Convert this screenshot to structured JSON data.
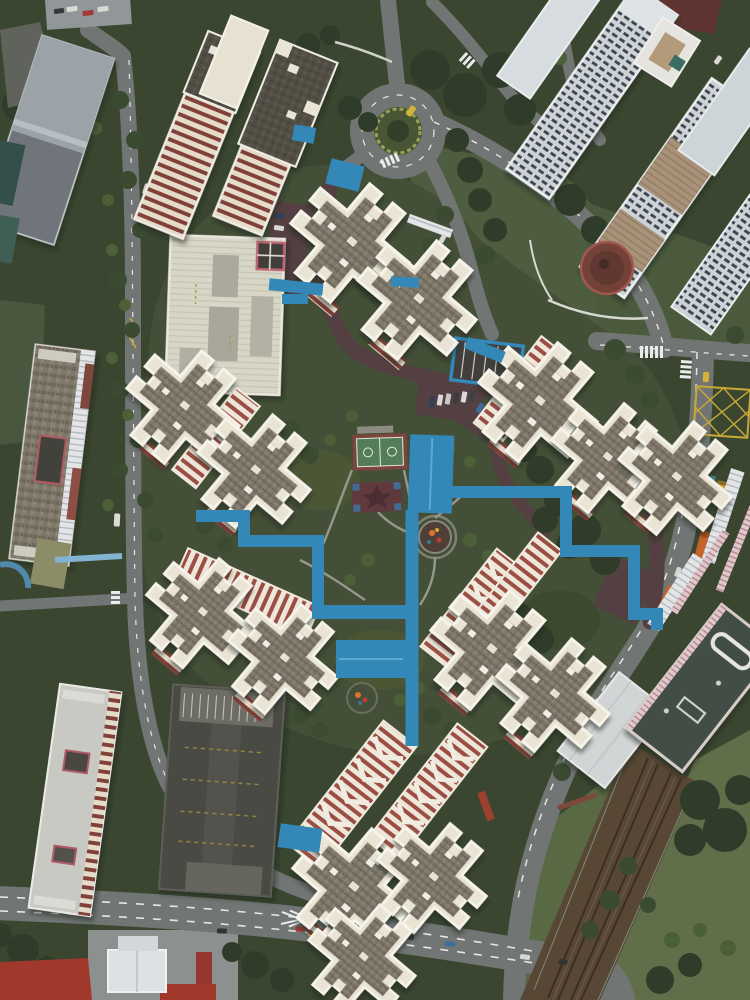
{
  "meta": {
    "title": "Top-down aerial drone photo of a high-rise public housing estate with cross-shaped tower blocks, blue covered walkways, roads, a roundabout and a rail station",
    "type": "aerial-drone-photograph",
    "canvas": {
      "width": 750,
      "height": 1000
    }
  },
  "palette": {
    "vegetation_base": "#35412a",
    "estate_lawn": "#3f4a31",
    "field_green": "#5c6b45",
    "field_green_light": "#55653f",
    "asphalt": "#6e7270",
    "estate_road": "#503a3d",
    "rail_bed": "#54422f",
    "walkway_blue": "#2d86b8",
    "walkway_blue_light": "#7fb2d2",
    "court_green": "#4e7a54",
    "court_border_red": "#7a4038",
    "station_roof": "#3d4a40",
    "tower_roof_grey": "#7b7466",
    "tower_roof_dark": "#4e4a41",
    "facade_cream": "#ece5d5",
    "facade_trim_white": "#f8f5ec",
    "facade_stripe_red": "#99493e",
    "highrise_pale": "#ccd3d7",
    "window_row_dark": "#3a424c",
    "carpark_deck_dark": "#44443f",
    "school_roof_pale": "#d9d7c6",
    "road_marking_white": "#e8e8e4",
    "marking_yellow": "#c8a832",
    "taxi_yellow": "#d4b232",
    "truck_orange": "#c65f24",
    "red_roof": "#a03226",
    "plaza_red_brown": "#713c33"
  },
  "scene": {
    "summary": "Vertical aerial view of a tropical public-housing estate: about fourteen cross-shaped apartment towers with grey roofs, white parapets and red-striped cream facades stand in clusters around a landscaped courtyard linked by bright blue covered walkways. The estate is ringed by roads with a tree-filled roundabout at top, a pale commercial high-rise cluster at top right, slab blocks and a dark multi-storey car park at left, a main road across the bottom, and an elevated rail corridor with station roof and grass fields at bottom right.",
    "estate": {
      "cross_shaped_towers": 14,
      "tower_clusters": 6,
      "twin_slab_towers": 2,
      "facade": "cream with red-brown horizontal stripe bands",
      "roof": "grey gravel with white parapet trim and small white vents",
      "courtyard_features": [
        "dark lawn",
        "basketball court",
        "red rubber play mat with star motif",
        "two circular playgrounds with orange and red equipment",
        "grey footpaths",
        "car-park deck trimmed in blue",
        "surface parking with white vans",
        "maroon internal service roads"
      ]
    },
    "landmarks": [
      {
        "name": "roundabout",
        "note": "green planted centre island with yellow taxi on ring road, top centre"
      },
      {
        "name": "covered-walkway-network",
        "note": "bright blue zig-zag linkways and canopies joining all tower clusters"
      },
      {
        "name": "basketball-court",
        "note": "green court with red surround and white markings"
      },
      {
        "name": "commercial-highrise-cluster",
        "note": "pale white-blue slab towers with dark window rows and tan roof decks, top right"
      },
      {
        "name": "circular-plaza",
        "note": "red-brown round amphitheatre below the high-rise cluster"
      },
      {
        "name": "multi-storey-carpark",
        "note": "long dark-roofed deck with lane markings, bottom left"
      },
      {
        "name": "white-slab-block",
        "note": "light-roofed residential slab beside the car park"
      },
      {
        "name": "school-podium-carpark",
        "note": "pale sage roofed podium with red-framed corner, upper left of estate"
      },
      {
        "name": "mrt-station",
        "note": "dark mossy-green station roof with white vent frame and pink-striped edge, bottom right"
      },
      {
        "name": "rail-corridor",
        "note": "brown track bed with twin rail pairs running diagonally to bottom edge"
      },
      {
        "name": "yellow-box-junction",
        "note": "yellow cross-hatched junction on the right-hand road"
      },
      {
        "name": "event-tents",
        "note": "white peaked canopies and red roofs along the bottom edge"
      }
    ],
    "roads": {
      "main_bottom_road": "dual-lane road with white dashes and yellow zig-zag kerb markings",
      "east_road": "curving avenue with bus and trucks, yellow bus-bay markings, flanked by ribbed shelter roofs",
      "west_road": "tree-lined local road with covered walkway",
      "internal": "maroon estate service loop with parking bays"
    },
    "vehicles": [
      {
        "color": "yellow",
        "type": "taxi",
        "location": "roundabout"
      },
      {
        "color": "yellow",
        "type": "taxi",
        "location": "north junction"
      },
      {
        "color": "yellow",
        "type": "bus",
        "location": "east road"
      },
      {
        "color": "orange",
        "type": "truck",
        "location": "east road"
      },
      {
        "color": "orange",
        "type": "truck",
        "location": "east road bus bay"
      },
      {
        "color": "red",
        "type": "bus",
        "location": "south-east road"
      },
      {
        "color": "red",
        "type": "car",
        "location": "east road"
      },
      {
        "color": "teal",
        "type": "car",
        "location": "east road"
      },
      {
        "color": "white",
        "type": "vans",
        "location": "estate parking row"
      },
      {
        "color": "mixed",
        "type": "cars",
        "location": "main bottom road"
      }
    ],
    "vegetation": "dense dark tropical tree canopy around roundabout, road verges, courtyard clumps and a large stand beside the rail corridor; lighter mown fields at bottom right"
  }
}
